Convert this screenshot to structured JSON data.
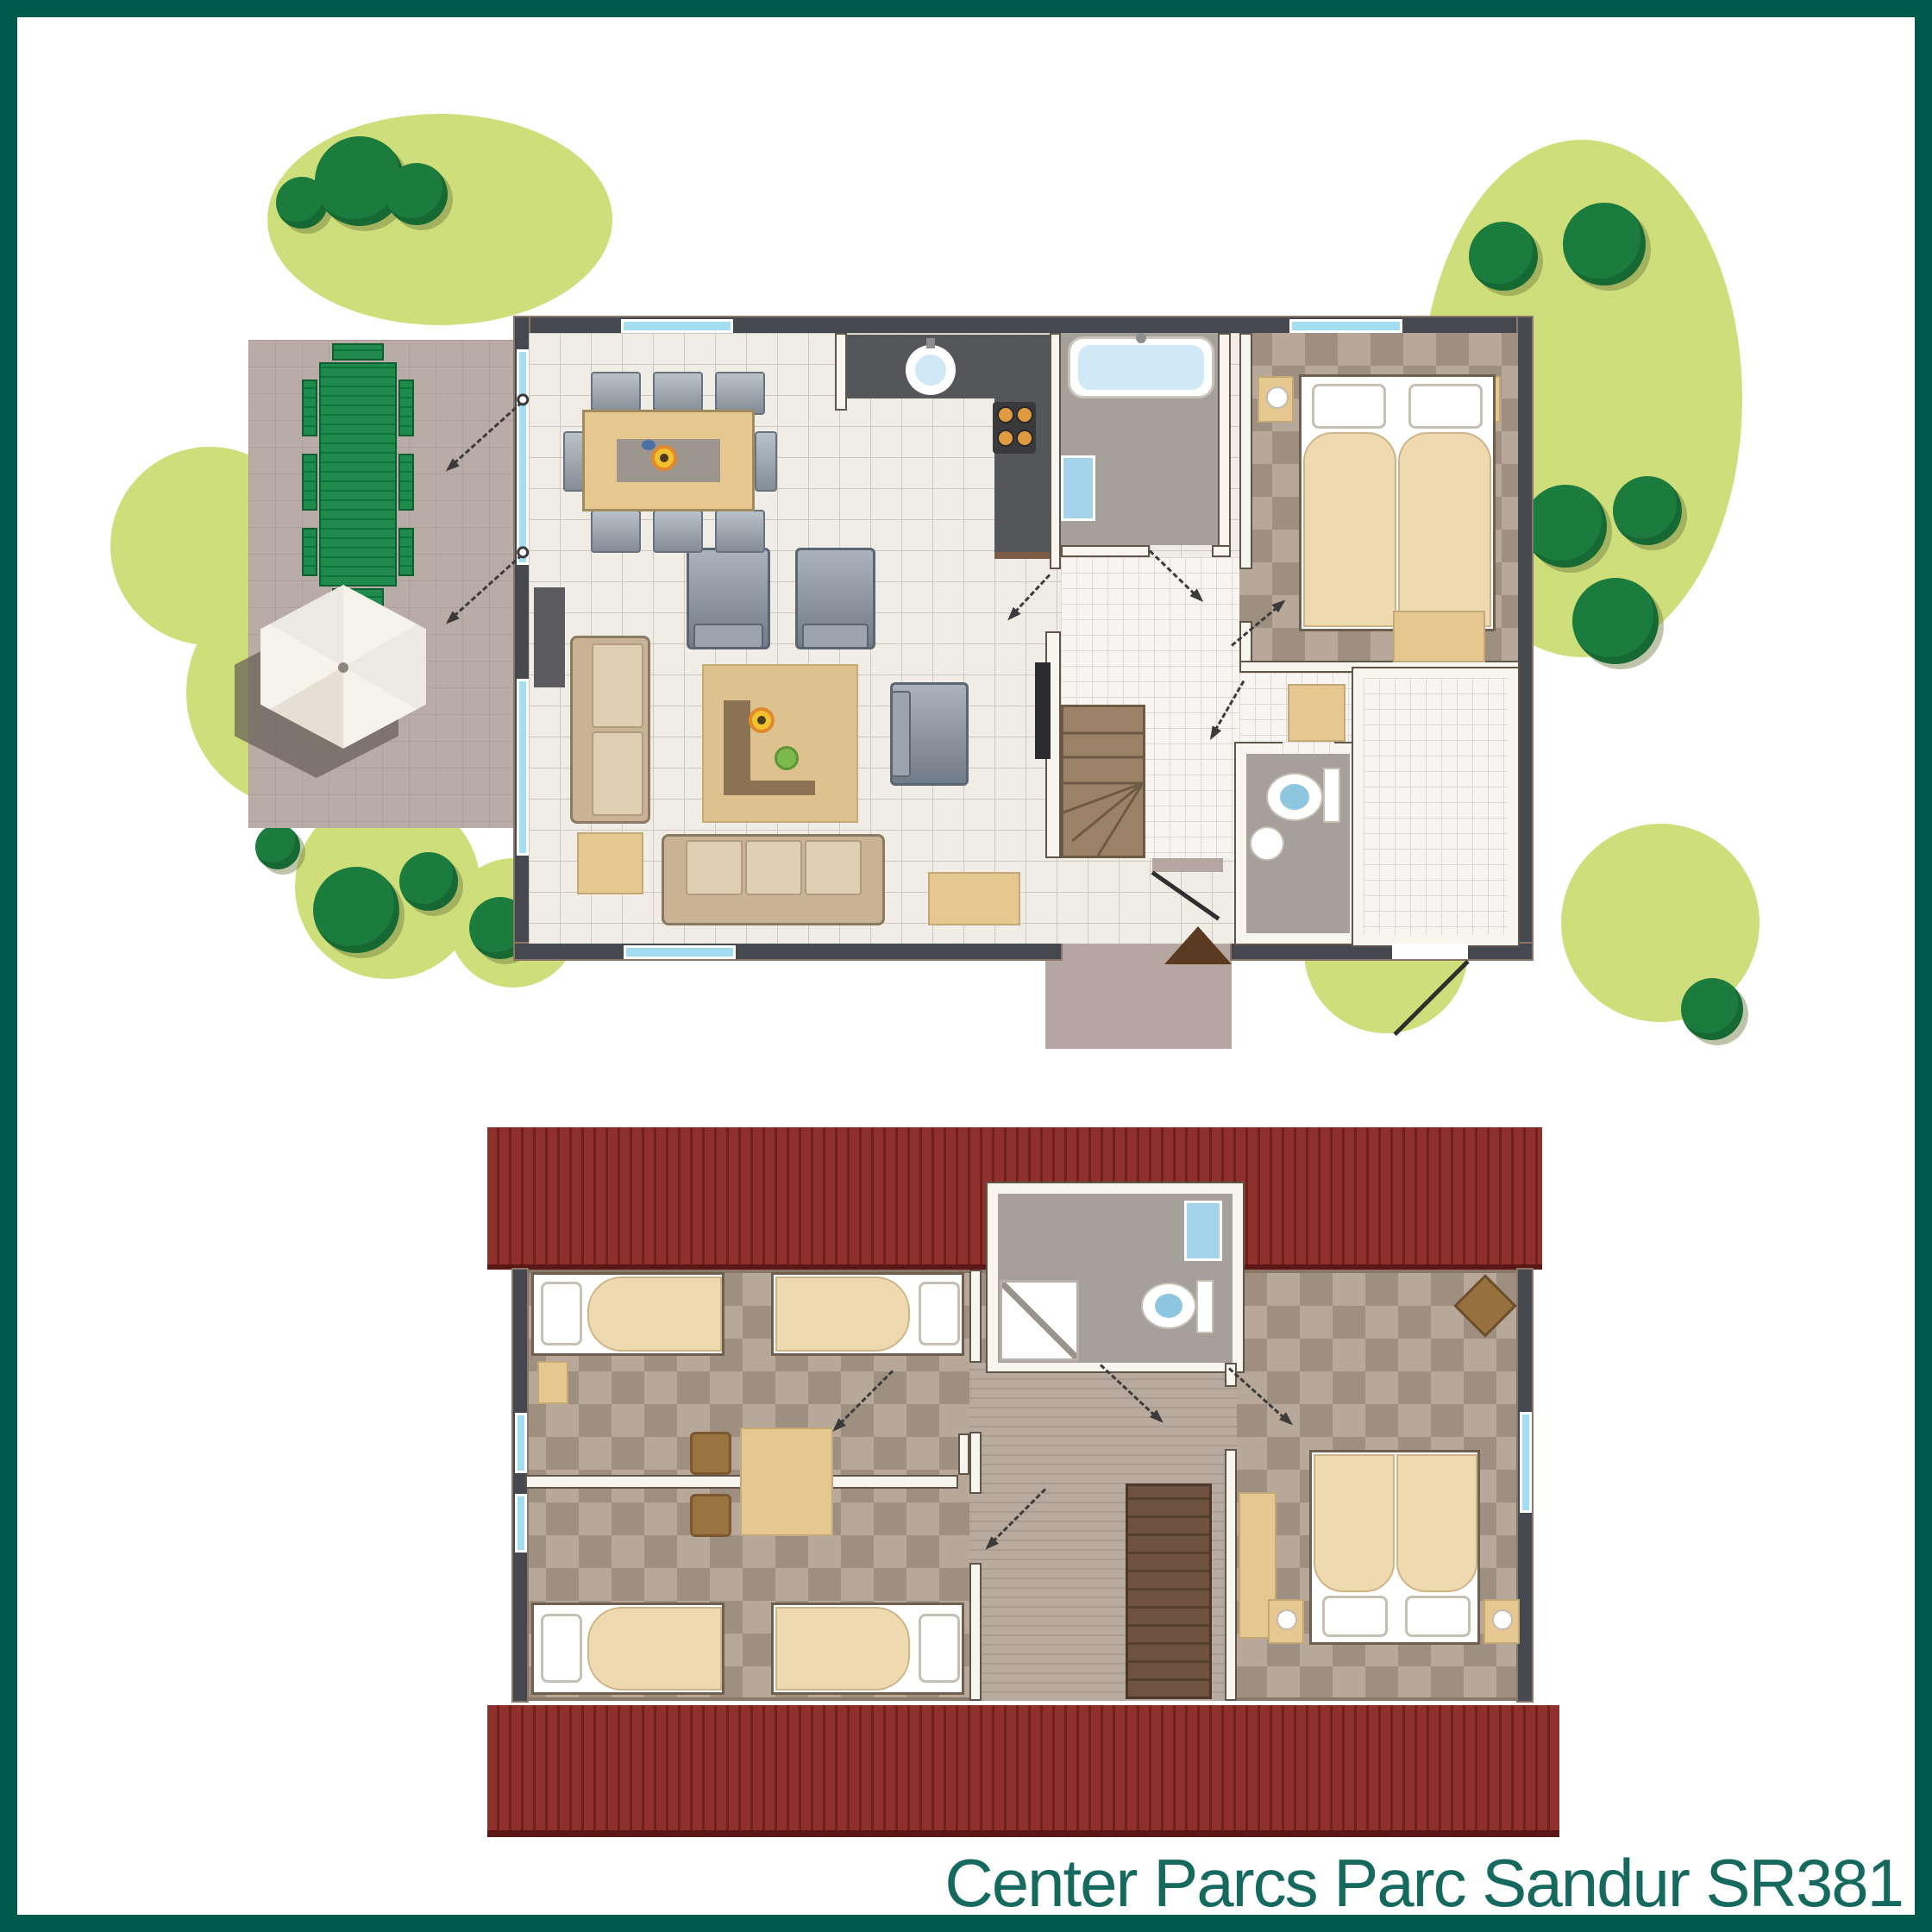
{
  "caption": {
    "text": "Center Parcs Parc Sandur SR381"
  },
  "palette": {
    "frame": "#005b4e",
    "background": "#ffffff",
    "captionColor": "#15695e",
    "garden": "#cdde7a",
    "tree": "#1b7c3d",
    "terrace": "#b9aba6",
    "porch": "#b5a6a0",
    "wallDark": "#45484e",
    "wallTrim": "#8a7767",
    "wallWhite": "#f8f4ee",
    "wallEdge": "#5f5549",
    "window": "#a2ddf2",
    "tile": "#f0ede7",
    "tileLine": "#cfc8bf",
    "fineTile": "#f7f5f1",
    "fineLine": "#ded9d1",
    "bathFloor": "#a6a09a",
    "checkerLight": "#b7a899",
    "checkerDark": "#9e8f81",
    "counter": "#55565a",
    "cooktop": "#3a3a3c",
    "burner": "#e09b40",
    "water": "#cfe9f6",
    "waterDeep": "#a4d4ec",
    "toiletBlue": "#8ec6e0",
    "roof": "#8e302c",
    "roofStripe": "#701f1d",
    "roofShadow": "#5a1716",
    "landing": "#b9aa9f",
    "landingLine": "#ab9c91",
    "stairGround": "#9b8166",
    "stairUpper": "#6f5340",
    "bedBlanket": "#eedaae",
    "bedOutline": "#6f5f4e",
    "pillow": "#ffffff",
    "tan": "#e6c78f",
    "tanDark": "#c3a878",
    "rug": "#ddc290",
    "woodDark": "#8a7252",
    "sofa": "#cab394",
    "sofaCushion": "#e0cfb0",
    "sofaEdge": "#8a7a64",
    "picnic": "#1f8a4c",
    "picnicDark": "#10753c",
    "parasol": "#f6f3ea",
    "parasolShadow": "#6b6258",
    "tv": "#2c2c2f",
    "arrow": "#3b3b3b",
    "flower": "#f2c12e",
    "flowerPot": "#e08a2d",
    "ball": "#7cb94d",
    "brownChair": "#9a7440",
    "triangle": "#5b3a22"
  }
}
